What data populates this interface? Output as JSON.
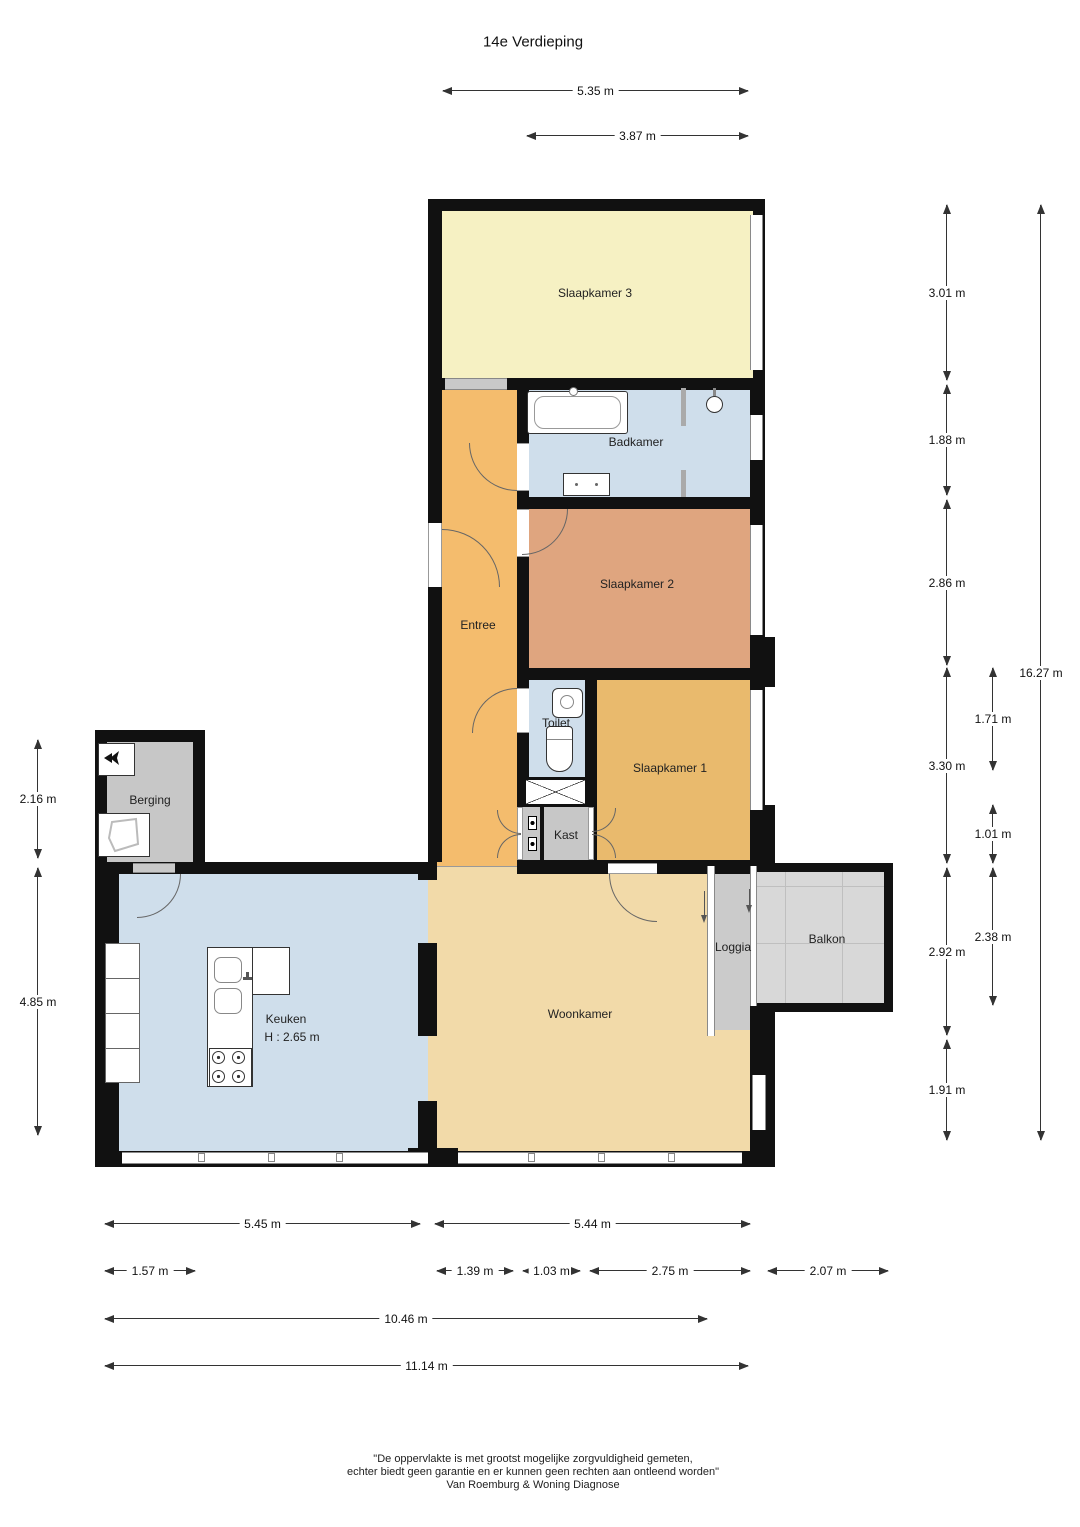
{
  "title": "14e Verdieping",
  "rooms": {
    "slaapkamer3": "Slaapkamer 3",
    "badkamer": "Badkamer",
    "entree": "Entree",
    "slaapkamer2": "Slaapkamer 2",
    "toilet": "Toilet",
    "slaapkamer1": "Slaapkamer 1",
    "kast": "Kast",
    "berging": "Berging",
    "keuken": "Keuken",
    "keuken_height": "H : 2.65 m",
    "woonkamer": "Woonkamer",
    "loggia": "Loggia",
    "balkon": "Balkon"
  },
  "dims": {
    "top": [
      "5.35 m",
      "3.87 m"
    ],
    "left": [
      "2.16 m",
      "4.85 m"
    ],
    "right_col1": [
      "3.01 m",
      "1.88 m",
      "2.86 m",
      "3.30 m",
      "2.92 m",
      "1.91 m"
    ],
    "right_col2": [
      "1.71 m",
      "1.01 m",
      "2.38 m"
    ],
    "right_total": "16.27 m",
    "bottom_row1": [
      "5.45 m",
      "5.44 m"
    ],
    "bottom_row2": [
      "1.57 m",
      "1.39 m",
      "1.03 m",
      "2.75 m",
      "2.07 m"
    ],
    "bottom_total1": "10.46 m",
    "bottom_total2": "11.14 m"
  },
  "footer": {
    "line1": "\"De oppervlakte is met grootst mogelijke zorgvuldigheid gemeten,",
    "line2": "echter biedt geen garantie en er kunnen geen rechten aan ontleend worden\"",
    "line3": "Van Roemburg & Woning Diagnose"
  },
  "colors": {
    "wall": "#111111",
    "slaapkamer3": "#f6f1c3",
    "badkamer": "#cfdeeb",
    "entree": "#f4bc6d",
    "slaapkamer2": "#dfa57f",
    "toilet": "#cfdeeb",
    "slaapkamer1": "#e9ba6d",
    "kast": "#c7c7c7",
    "berging": "#c7c7c7",
    "keuken": "#cfdeeb",
    "woonkamer": "#f2daa9",
    "loggia": "#cbcbcb",
    "balkon": "#d8d8d8"
  }
}
